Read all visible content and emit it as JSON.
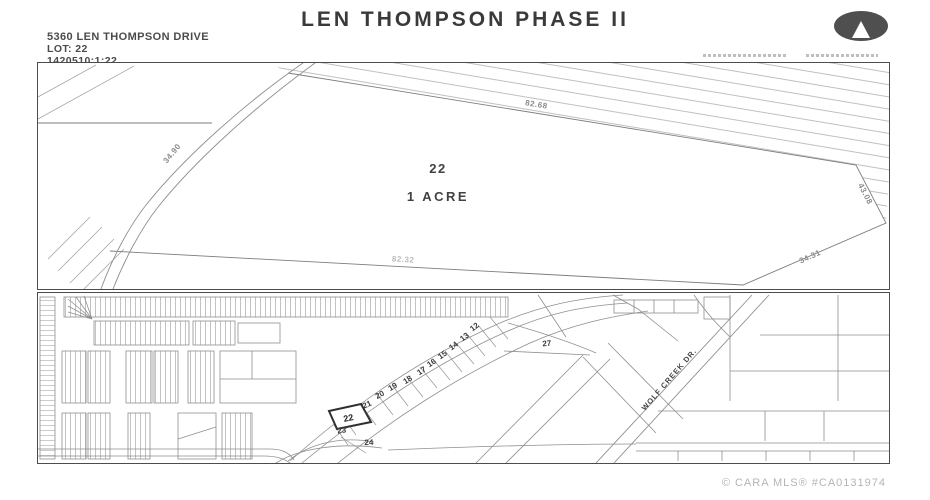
{
  "header": {
    "title": "LEN THOMPSON PHASE II",
    "address": "5360 LEN THOMPSON DRIVE",
    "lot": "LOT: 22",
    "legal_id": "1420510;1;22"
  },
  "plat": {
    "lot_number": "22",
    "area_label": "1 ACRE",
    "dim_top": "82.68",
    "dim_right": "43.08",
    "dim_bottom_right": "34.31",
    "dim_bottom": "82.32",
    "dim_left_curve": "34.90"
  },
  "map": {
    "street_label": "WOLF CREEK DR.",
    "lot_27": "27",
    "lot_numbers": [
      "12",
      "13",
      "14",
      "15",
      "16",
      "17",
      "18",
      "19",
      "20",
      "21",
      "22",
      "23",
      "24"
    ]
  },
  "footer": {
    "watermark": "© CARA MLS® #CA0131974"
  },
  "colors": {
    "border": "#4c4c4c",
    "line": "#8f8f8f",
    "hatch": "#b0b0b0",
    "dim_label": "#8a8a8a",
    "title_text": "#3a3a3a",
    "watermark": "#b5b5b5",
    "logo_bg": "#4f4f4f"
  }
}
